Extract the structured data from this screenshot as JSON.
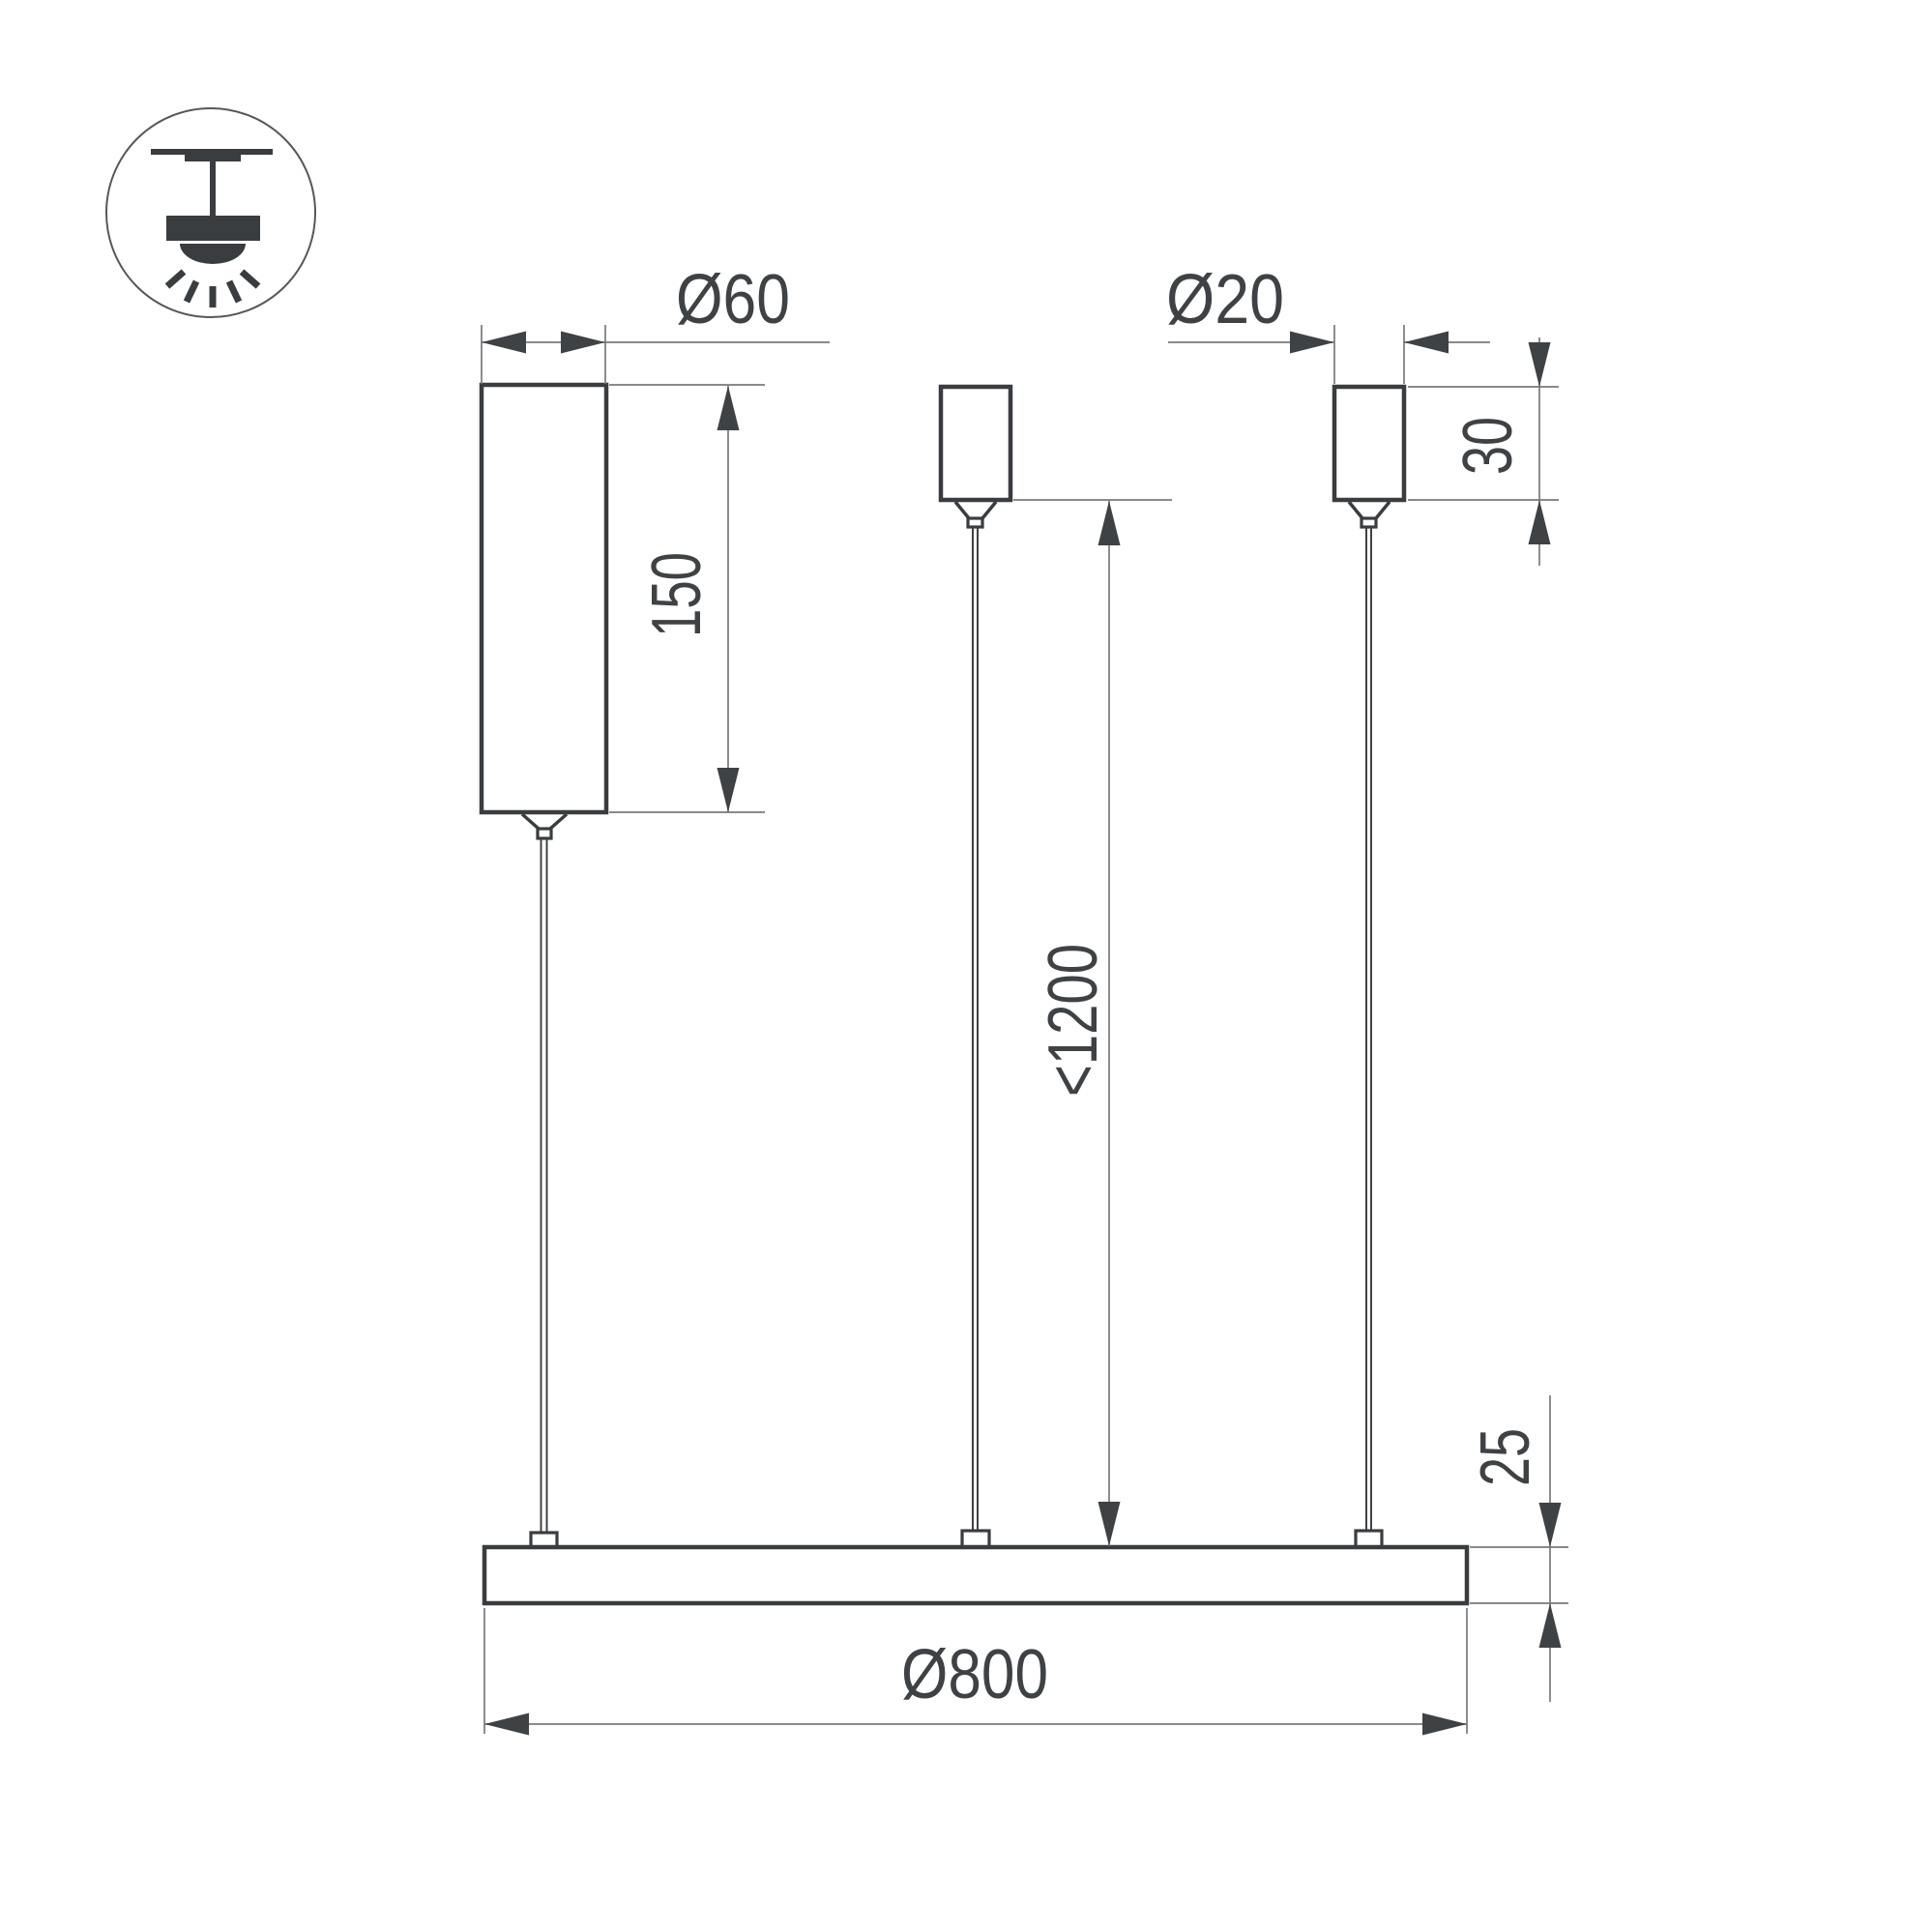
{
  "drawing": {
    "title": "Suspension luminaire dimension drawing",
    "icon": {
      "name": "pendant-ceiling-mount"
    },
    "dims": {
      "driver_diameter": "Ø60",
      "driver_height": "150",
      "canopy_diameter": "Ø20",
      "canopy_height": "30",
      "suspension_length": "<1200",
      "ring_height": "25",
      "ring_diameter": "Ø800"
    },
    "colors": {
      "outline": "#3a3d40",
      "line": "#77797c",
      "text": "#3f4245",
      "background": "#ffffff"
    }
  }
}
